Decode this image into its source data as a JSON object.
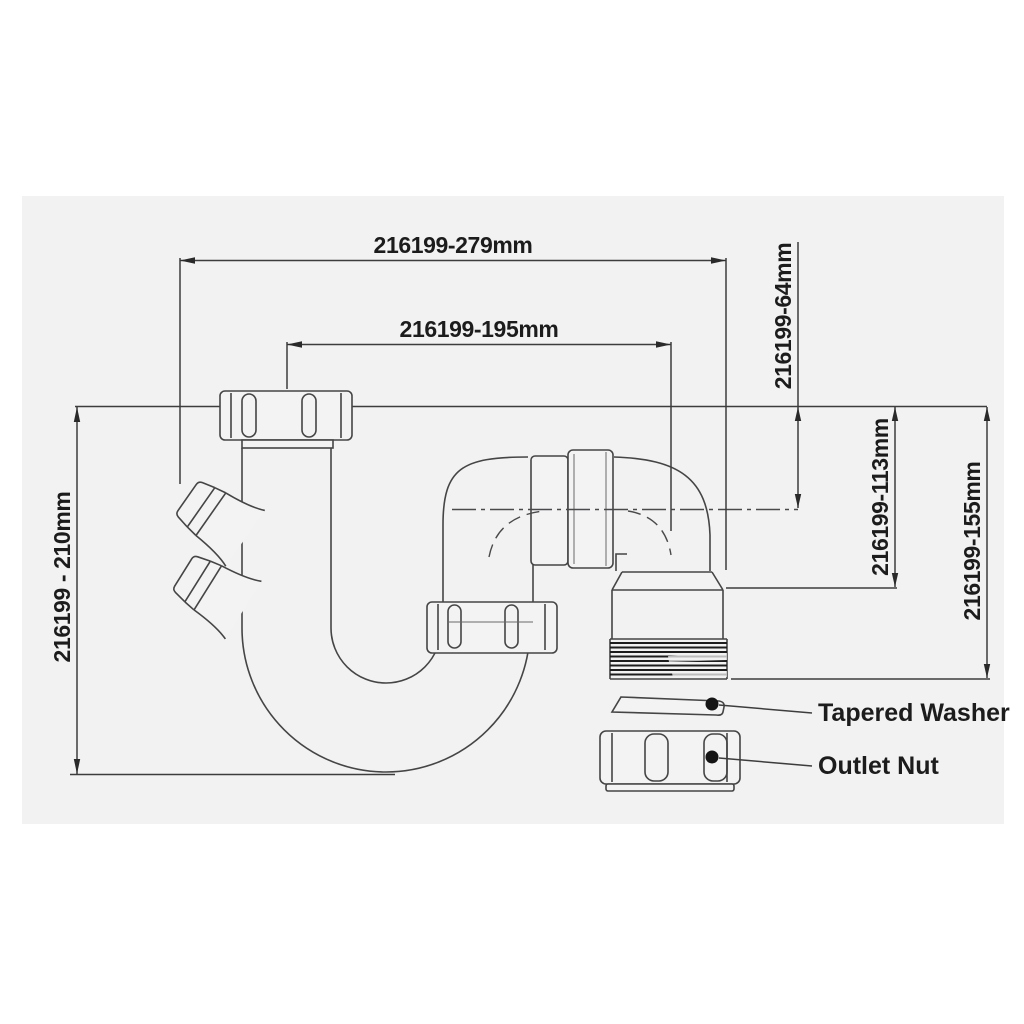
{
  "product_code": "216199",
  "dimensions": [
    {
      "id": "overall-width",
      "label": "216199-279mm"
    },
    {
      "id": "inlet-to-outlet-width",
      "label": "216199-195mm"
    },
    {
      "id": "top-to-centerline-depth",
      "label": "216199-64mm"
    },
    {
      "id": "top-to-outlet-body-depth",
      "label": "216199-113mm"
    },
    {
      "id": "top-to-outlet-end-depth",
      "label": "216199-155mm"
    },
    {
      "id": "overall-height",
      "label": "216199 - 210mm"
    }
  ],
  "callouts": [
    {
      "id": "tapered-washer",
      "label": "Tapered Washer"
    },
    {
      "id": "outlet-nut",
      "label": "Outlet Nut"
    }
  ],
  "colors": {
    "background": "#ffffff",
    "panel": "#f2f2f3",
    "line": "#454545",
    "dimension_line": "#3d3d3d",
    "text": "#1c1c1c",
    "thread": "#1d1d1d"
  }
}
